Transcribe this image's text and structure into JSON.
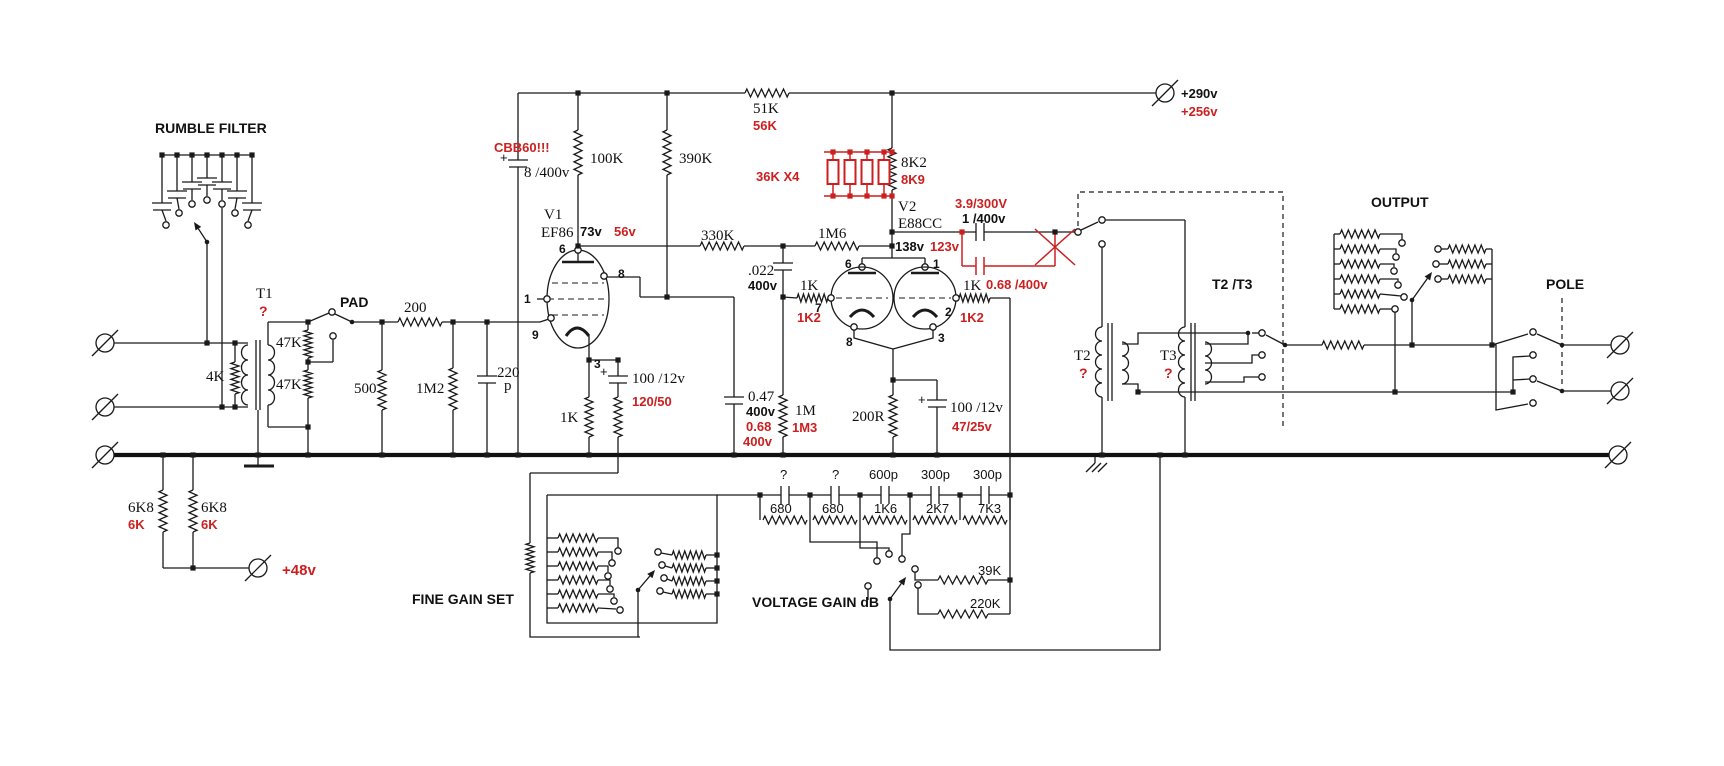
{
  "meta": {
    "background": "#ffffff",
    "ink_color": "#1a1a1a",
    "annotation_red": "#cc1f1f",
    "description_note": "tube preamp schematic with black original values and red modification values"
  },
  "labels": [
    {
      "n": "title-rumble-filter",
      "t": "RUMBLE FILTER",
      "x": 155,
      "y": 133,
      "c": "t"
    },
    {
      "n": "title-pad",
      "t": "PAD",
      "x": 340,
      "y": 307,
      "c": "t"
    },
    {
      "n": "title-fine-gain-set",
      "t": "FINE GAIN SET",
      "x": 412,
      "y": 604,
      "c": "t"
    },
    {
      "n": "title-voltage-gain",
      "t": "VOLTAGE GAIN dB",
      "x": 752,
      "y": 607,
      "c": "t"
    },
    {
      "n": "title-output",
      "t": "OUTPUT",
      "x": 1371,
      "y": 207,
      "c": "t"
    },
    {
      "n": "title-t2t3",
      "t": "T2 /T3",
      "x": 1212,
      "y": 289,
      "c": "t"
    },
    {
      "n": "title-pole",
      "t": "POLE",
      "x": 1546,
      "y": 289,
      "c": "t"
    },
    {
      "n": "t1-name",
      "t": "T1",
      "x": 256,
      "y": 298,
      "c": "s"
    },
    {
      "n": "t1-query",
      "t": "?",
      "x": 259,
      "y": 316,
      "c": "rq"
    },
    {
      "n": "r-4k",
      "t": "4K",
      "x": 206,
      "y": 381,
      "c": "s"
    },
    {
      "n": "r-47k-a",
      "t": "47K",
      "x": 276,
      "y": 347,
      "c": "s"
    },
    {
      "n": "r-47k-b",
      "t": "47K",
      "x": 276,
      "y": 389,
      "c": "s"
    },
    {
      "n": "r-200",
      "t": "200",
      "x": 404,
      "y": 312,
      "c": "s"
    },
    {
      "n": "r-500",
      "t": "500",
      "x": 354,
      "y": 393,
      "c": "s"
    },
    {
      "n": "r-1m2",
      "t": "1M2",
      "x": 416,
      "y": 393,
      "c": "s"
    },
    {
      "n": "c-220p-a",
      "t": "220",
      "x": 497,
      "y": 377,
      "c": "s"
    },
    {
      "n": "c-220p-b",
      "t": "p",
      "x": 504,
      "y": 390,
      "c": "s"
    },
    {
      "n": "r-6k8-a",
      "t": "6K8",
      "x": 128,
      "y": 512,
      "c": "s"
    },
    {
      "n": "r-6k8-a-mod",
      "t": "6K",
      "x": 128,
      "y": 529,
      "c": "r"
    },
    {
      "n": "r-6k8-b",
      "t": "6K8",
      "x": 201,
      "y": 512,
      "c": "s"
    },
    {
      "n": "r-6k8-b-mod",
      "t": "6K",
      "x": 201,
      "y": 529,
      "c": "r"
    },
    {
      "n": "phantom-48v",
      "t": "+48v",
      "x": 282,
      "y": 575,
      "c": "lrb"
    },
    {
      "n": "cap-cbb60-warn",
      "t": "CBB60!!!",
      "x": 494,
      "y": 152,
      "c": "r"
    },
    {
      "n": "cap-8-400v",
      "t": "8 /400v",
      "x": 524,
      "y": 177,
      "c": "s"
    },
    {
      "n": "plus-8-400v",
      "t": "+",
      "x": 500,
      "y": 162,
      "c": "lp"
    },
    {
      "n": "r-100k",
      "t": "100K",
      "x": 590,
      "y": 163,
      "c": "s"
    },
    {
      "n": "r-390k",
      "t": "390K",
      "x": 679,
      "y": 163,
      "c": "s"
    },
    {
      "n": "v1-name",
      "t": "V1",
      "x": 544,
      "y": 219,
      "c": "s"
    },
    {
      "n": "v1-type",
      "t": "EF86",
      "x": 541,
      "y": 237,
      "c": "s"
    },
    {
      "n": "v1-volt",
      "t": "73v",
      "x": 580,
      "y": 236,
      "c": "lb"
    },
    {
      "n": "v1-volt-mod",
      "t": "56v",
      "x": 614,
      "y": 236,
      "c": "r"
    },
    {
      "n": "v1-pin6",
      "t": "6",
      "x": 559,
      "y": 253,
      "c": "p"
    },
    {
      "n": "v1-pin8",
      "t": "8",
      "x": 618,
      "y": 278,
      "c": "p"
    },
    {
      "n": "v1-pin1",
      "t": "1",
      "x": 524,
      "y": 303,
      "c": "p"
    },
    {
      "n": "v1-pin9",
      "t": "9",
      "x": 532,
      "y": 339,
      "c": "p"
    },
    {
      "n": "v1-pin3",
      "t": "3",
      "x": 594,
      "y": 368,
      "c": "p"
    },
    {
      "n": "r-1k-v1",
      "t": "1K",
      "x": 560,
      "y": 422,
      "c": "s"
    },
    {
      "n": "c-100-12v-v1",
      "t": "100 /12v",
      "x": 632,
      "y": 383,
      "c": "s"
    },
    {
      "n": "plus-100-12-v1",
      "t": "+",
      "x": 600,
      "y": 376,
      "c": "lp"
    },
    {
      "n": "c-100-12v-v1-mod",
      "t": "120/50",
      "x": 632,
      "y": 406,
      "c": "r"
    },
    {
      "n": "r-51k",
      "t": "51K",
      "x": 753,
      "y": 113,
      "c": "s"
    },
    {
      "n": "r-51k-mod",
      "t": "56K",
      "x": 753,
      "y": 130,
      "c": "r"
    },
    {
      "n": "r-330k",
      "t": "330K",
      "x": 701,
      "y": 240,
      "c": "s"
    },
    {
      "n": "r-1m6",
      "t": "1M6",
      "x": 818,
      "y": 238,
      "c": "s"
    },
    {
      "n": "r-36kx4",
      "t": "36K X4",
      "x": 756,
      "y": 181,
      "c": "r"
    },
    {
      "n": "r-8k2",
      "t": "8K2",
      "x": 901,
      "y": 167,
      "c": "s"
    },
    {
      "n": "r-8k2-mod",
      "t": "8K9",
      "x": 901,
      "y": 184,
      "c": "r"
    },
    {
      "n": "v2-name",
      "t": "V2",
      "x": 898,
      "y": 211,
      "c": "s"
    },
    {
      "n": "v2-type",
      "t": "E88CC",
      "x": 898,
      "y": 228,
      "c": "s"
    },
    {
      "n": "v2-volt",
      "t": "138v",
      "x": 895,
      "y": 251,
      "c": "lb"
    },
    {
      "n": "v2-volt-mod",
      "t": "123v",
      "x": 930,
      "y": 251,
      "c": "r"
    },
    {
      "n": "c-022",
      "t": ".022",
      "x": 748,
      "y": 275,
      "c": "s"
    },
    {
      "n": "c-022-v",
      "t": "400v",
      "x": 748,
      "y": 290,
      "c": "lb"
    },
    {
      "n": "r-1k-g1",
      "t": "1K",
      "x": 800,
      "y": 290,
      "c": "s"
    },
    {
      "n": "r-1k-g1-mod",
      "t": "1K2",
      "x": 797,
      "y": 322,
      "c": "r"
    },
    {
      "n": "v2-pin7",
      "t": "7",
      "x": 815,
      "y": 312,
      "c": "p"
    },
    {
      "n": "r-1k-g2",
      "t": "1K",
      "x": 963,
      "y": 290,
      "c": "s"
    },
    {
      "n": "r-1k-g2-mod",
      "t": "1K2",
      "x": 960,
      "y": 322,
      "c": "r"
    },
    {
      "n": "v2-pin2",
      "t": "2",
      "x": 945,
      "y": 316,
      "c": "p"
    },
    {
      "n": "v2-pin6",
      "t": "6",
      "x": 845,
      "y": 268,
      "c": "p"
    },
    {
      "n": "v2-pin1",
      "t": "1",
      "x": 933,
      "y": 268,
      "c": "p"
    },
    {
      "n": "v2-pin8",
      "t": "8",
      "x": 846,
      "y": 346,
      "c": "p"
    },
    {
      "n": "v2-pin3",
      "t": "3",
      "x": 938,
      "y": 342,
      "c": "p"
    },
    {
      "n": "c-couple-mod",
      "t": "3.9/300V",
      "x": 955,
      "y": 208,
      "c": "r"
    },
    {
      "n": "c-couple",
      "t": "1 /400v",
      "x": 962,
      "y": 223,
      "c": "lb"
    },
    {
      "n": "c-068-400v",
      "t": "0.68 /400v",
      "x": 986,
      "y": 289,
      "c": "r"
    },
    {
      "n": "c-047",
      "t": "0.47",
      "x": 748,
      "y": 401,
      "c": "s"
    },
    {
      "n": "c-047-v",
      "t": "400v",
      "x": 746,
      "y": 416,
      "c": "lb"
    },
    {
      "n": "c-047-mod",
      "t": "0.68",
      "x": 746,
      "y": 431,
      "c": "r"
    },
    {
      "n": "c-047-mod-v",
      "t": "400v",
      "x": 743,
      "y": 446,
      "c": "r"
    },
    {
      "n": "r-1m",
      "t": "1M",
      "x": 795,
      "y": 415,
      "c": "s"
    },
    {
      "n": "r-1m-mod",
      "t": "1M3",
      "x": 792,
      "y": 432,
      "c": "r"
    },
    {
      "n": "r-200r",
      "t": "200R",
      "x": 852,
      "y": 421,
      "c": "s"
    },
    {
      "n": "c-100-12v-v2",
      "t": "100 /12v",
      "x": 950,
      "y": 412,
      "c": "s"
    },
    {
      "n": "plus-100-12-v2",
      "t": "+",
      "x": 918,
      "y": 404,
      "c": "lp"
    },
    {
      "n": "c-100-12v-v2-mod",
      "t": "47/25v",
      "x": 952,
      "y": 431,
      "c": "r"
    },
    {
      "n": "b-plus",
      "t": "+290v",
      "x": 1181,
      "y": 98,
      "c": "lb"
    },
    {
      "n": "b-plus-mod",
      "t": "+256v",
      "x": 1181,
      "y": 116,
      "c": "r"
    },
    {
      "n": "vg-cap-1",
      "t": "?",
      "x": 780,
      "y": 479,
      "c": "n"
    },
    {
      "n": "vg-cap-2",
      "t": "?",
      "x": 832,
      "y": 479,
      "c": "n"
    },
    {
      "n": "vg-cap-3",
      "t": "600p",
      "x": 869,
      "y": 479,
      "c": "n"
    },
    {
      "n": "vg-cap-4",
      "t": "300p",
      "x": 921,
      "y": 479,
      "c": "n"
    },
    {
      "n": "vg-cap-5",
      "t": "300p",
      "x": 973,
      "y": 479,
      "c": "n"
    },
    {
      "n": "vg-res-1",
      "t": "680",
      "x": 770,
      "y": 513,
      "c": "n"
    },
    {
      "n": "vg-res-2",
      "t": "680",
      "x": 822,
      "y": 513,
      "c": "n"
    },
    {
      "n": "vg-res-3",
      "t": "1K6",
      "x": 874,
      "y": 513,
      "c": "n"
    },
    {
      "n": "vg-res-4",
      "t": "2K7",
      "x": 926,
      "y": 513,
      "c": "n"
    },
    {
      "n": "vg-res-5",
      "t": "7K3",
      "x": 978,
      "y": 513,
      "c": "n"
    },
    {
      "n": "vg-res-39k",
      "t": "39K",
      "x": 978,
      "y": 575,
      "c": "n"
    },
    {
      "n": "vg-res-220k",
      "t": "220K",
      "x": 970,
      "y": 608,
      "c": "n"
    },
    {
      "n": "t2-name",
      "t": "T2",
      "x": 1074,
      "y": 360,
      "c": "s"
    },
    {
      "n": "t2-query",
      "t": "?",
      "x": 1079,
      "y": 378,
      "c": "rq"
    },
    {
      "n": "t3-name",
      "t": "T3",
      "x": 1160,
      "y": 360,
      "c": "s"
    },
    {
      "n": "t3-query",
      "t": "?",
      "x": 1164,
      "y": 378,
      "c": "rq"
    }
  ]
}
